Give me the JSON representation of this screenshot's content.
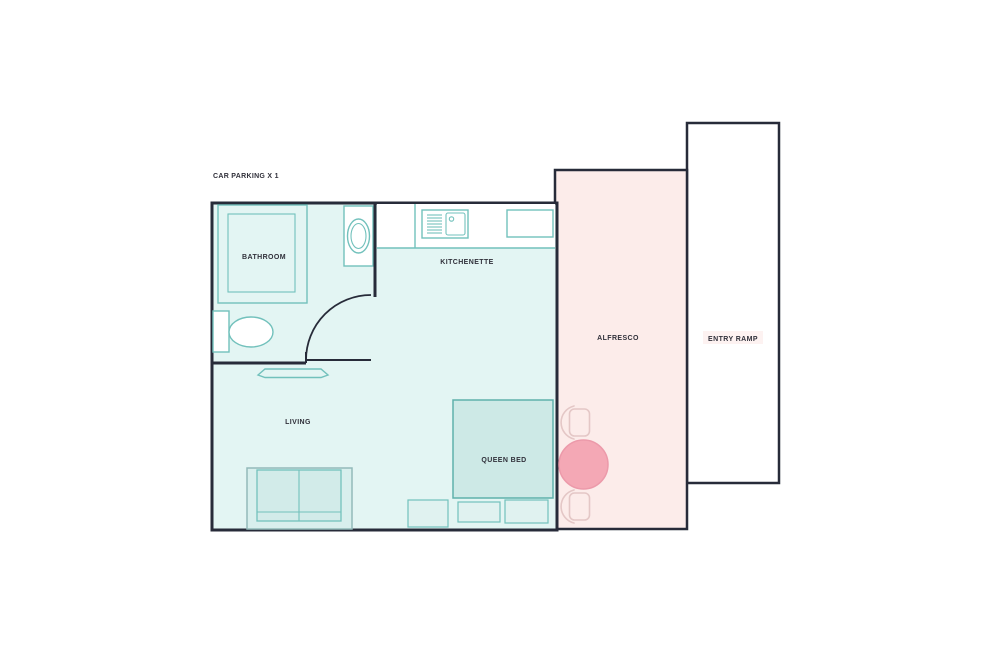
{
  "plan": {
    "type": "studio-unit-floor-plan",
    "note": {
      "car_parking": "CAR PARKING X 1"
    },
    "rooms": {
      "bathroom": {
        "label": "BATHROOM"
      },
      "kitchenette": {
        "label": "KITCHENETTE"
      },
      "living": {
        "label": "LIVING"
      },
      "queen_bed": {
        "label": "QUEEN BED"
      },
      "alfresco": {
        "label": "ALFRESCO"
      },
      "entry_ramp": {
        "label": "ENTRY RAMP"
      }
    }
  },
  "colors": {
    "wall": "#272b39",
    "text": "#30303a",
    "unit_fill": "#e3f5f3",
    "counter_fill": "#ffffff",
    "fixture": "#72c1bc",
    "bed_fill": "#cde9e6",
    "bed_stroke": "#5fb1ab",
    "sofa_outer_stroke": "#93bab9",
    "sofa_fill": "#d8efed",
    "sofa_inner_fill": "#d2ebe9",
    "small_rect_fill": "#e0f2f0",
    "alfresco_fill": "#fcecea",
    "ramp_fill": "#fdf2f1",
    "ramp_stripe": "#f6dddd",
    "table_fill": "#f4a8b5",
    "table_stroke": "#ec9aaa",
    "chair_stroke": "#e4c7c6"
  }
}
